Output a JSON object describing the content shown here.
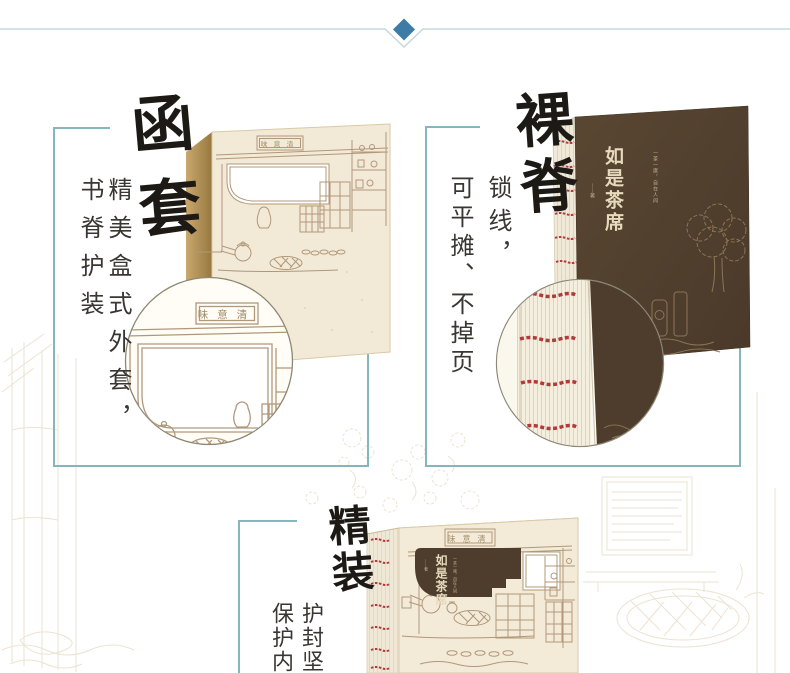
{
  "page": {
    "background": "#ffffff",
    "divider": {
      "line_color": "#c6d8de",
      "diamond_color": "#3e7ca8"
    },
    "frame_color": "#84b6bb"
  },
  "sections": {
    "slipcase": {
      "heading": "函套",
      "desc1": "精美盒式外套，",
      "desc2": "书脊护装"
    },
    "naked_spine": {
      "heading": "裸脊",
      "desc1": "锁线，",
      "desc2": "可平摊、不掉页"
    },
    "hardcover": {
      "heading": "精装",
      "desc1": "护封坚",
      "desc2": "保护内"
    }
  },
  "book": {
    "title": "如是茶席",
    "subtitle": "一茶一席，自在人间",
    "author": "——著",
    "plaque": "味意清",
    "cover_color": "#4e3d2c",
    "paper_color": "#f2ead7",
    "stitch_color": "#b23a3b"
  }
}
